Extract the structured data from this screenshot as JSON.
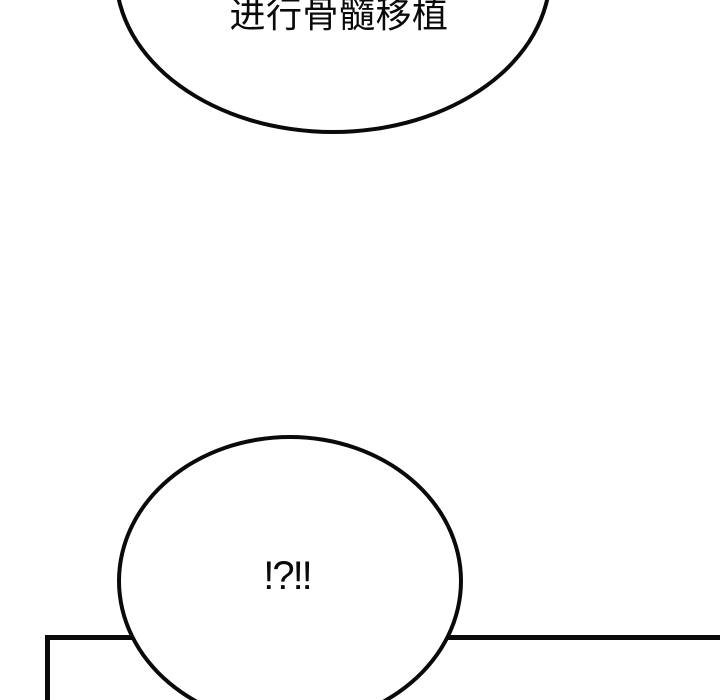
{
  "page": {
    "type": "comic-panel-strip"
  },
  "colors": {
    "background": "#ffffff",
    "line": "#0a0a0a"
  },
  "speech_bubbles": [
    {
      "id": "top",
      "text": "进行骨髓移植"
    },
    {
      "id": "bottom",
      "text": "!?!!"
    }
  ]
}
